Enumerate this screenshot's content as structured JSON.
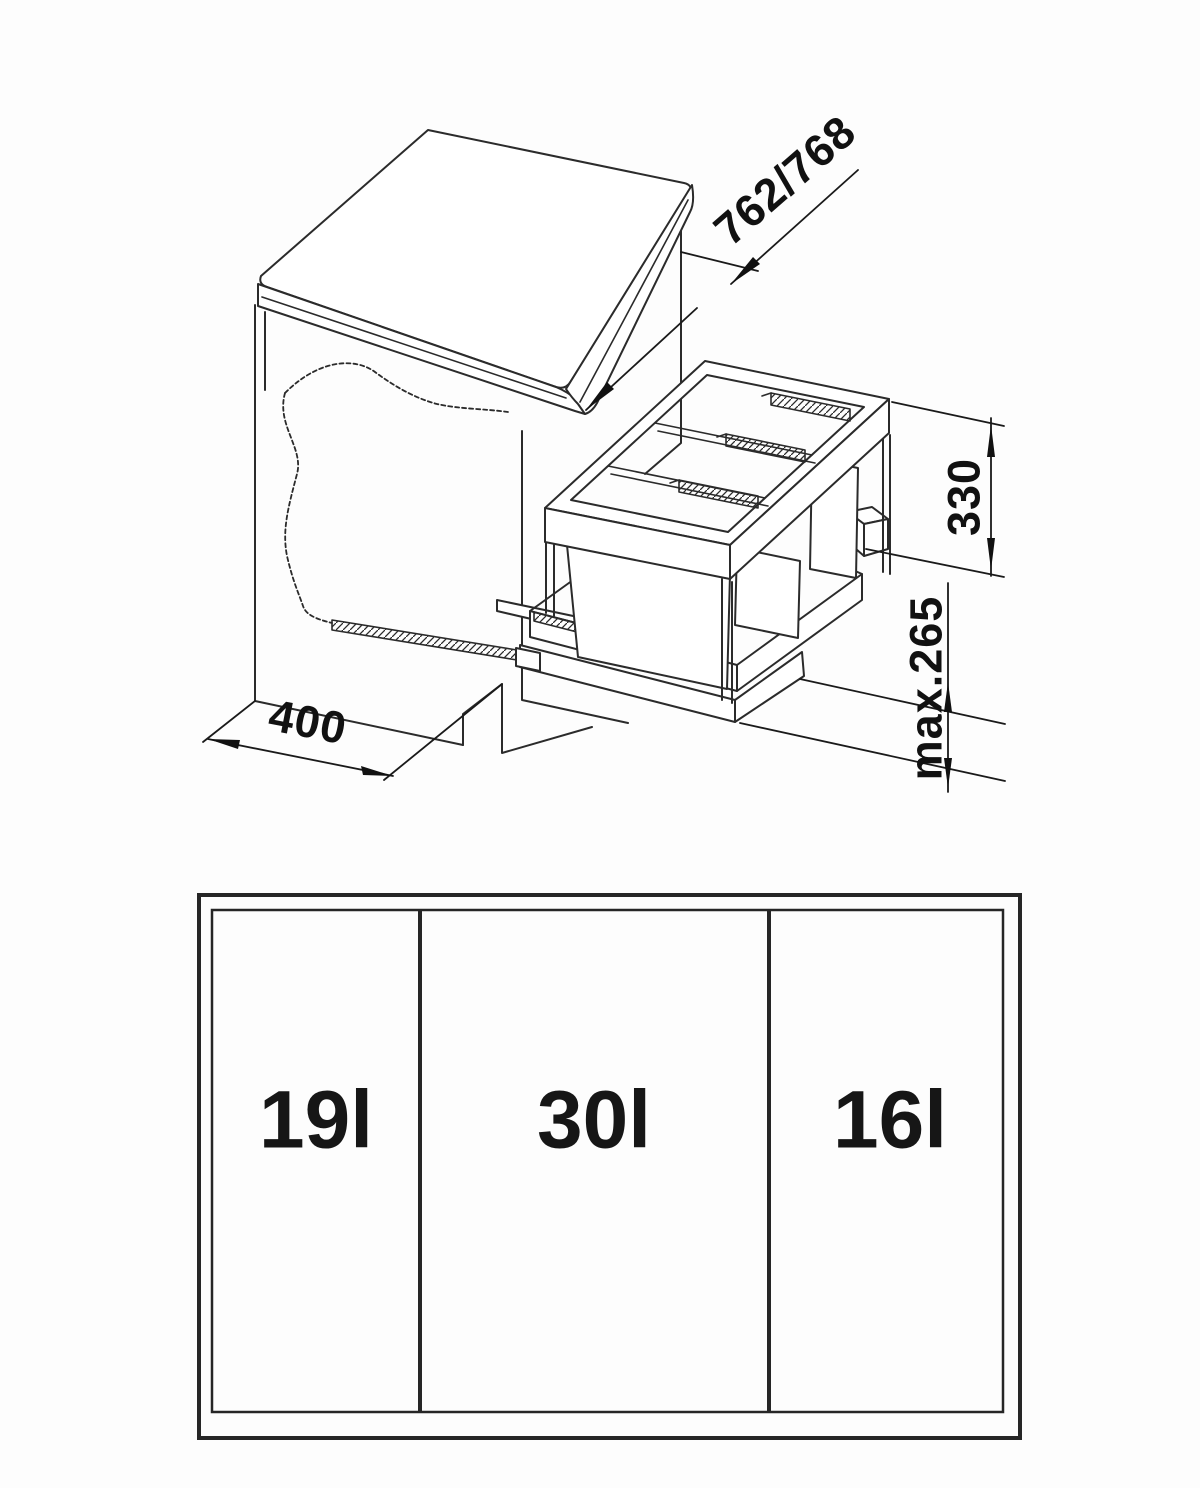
{
  "colors": {
    "line": "#2b2b2b",
    "text": "#111111",
    "background": "#ffffff"
  },
  "isometric_view": {
    "description": "Base cabinet with pull-out triple waste bin unit",
    "dimensions": {
      "depth": {
        "label": "762/768"
      },
      "frame_height": {
        "label": "330"
      },
      "max_bin_height": {
        "label": "max.265"
      },
      "cabinet_width": {
        "label": "400"
      }
    }
  },
  "plan_view": {
    "compartments": [
      {
        "label": "19l"
      },
      {
        "label": "30l"
      },
      {
        "label": "16l"
      }
    ]
  }
}
